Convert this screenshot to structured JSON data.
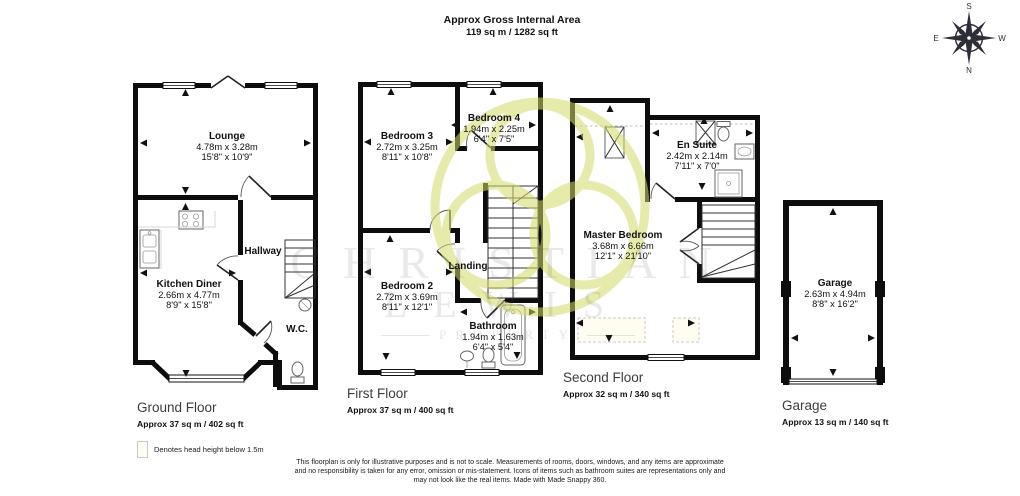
{
  "title": {
    "line1": "Approx Gross Internal Area",
    "line2": "119 sq m / 1282 sq ft"
  },
  "compass": {
    "north": "N",
    "south": "S",
    "east": "E",
    "west": "W"
  },
  "watermark": {
    "line1": "CHRISTIAN",
    "line2": "LEWIS",
    "line3": "PROPERTY"
  },
  "floors": [
    {
      "name": "Ground Floor",
      "area": "Approx 37 sq m / 402 sq ft",
      "rooms": [
        {
          "name": "Lounge",
          "metric": "4.78m x 3.28m",
          "imperial": "15'8\" x 10'9\""
        },
        {
          "name": "Kitchen Diner",
          "metric": "2.66m x 4.77m",
          "imperial": "8'9\" x 15'8\""
        },
        {
          "name": "Hallway"
        },
        {
          "name": "W.C."
        }
      ]
    },
    {
      "name": "First Floor",
      "area": "Approx 37 sq m / 400 sq ft",
      "rooms": [
        {
          "name": "Bedroom 3",
          "metric": "2.72m x 3.25m",
          "imperial": "8'11\" x 10'8\""
        },
        {
          "name": "Bedroom 4",
          "metric": "1.94m x 2.25m",
          "imperial": "6'4\" x 7'5\""
        },
        {
          "name": "Bedroom 2",
          "metric": "2.72m x 3.69m",
          "imperial": "8'11\" x 12'1\""
        },
        {
          "name": "Landing"
        },
        {
          "name": "Bathroom",
          "metric": "1.94m x 1.63m",
          "imperial": "6'4\" x 5'4\""
        }
      ]
    },
    {
      "name": "Second Floor",
      "area": "Approx 32 sq m / 340 sq ft",
      "rooms": [
        {
          "name": "Master Bedroom",
          "metric": "3.68m x 6.66m",
          "imperial": "12'1\" x 21'10\""
        },
        {
          "name": "En Suite",
          "metric": "2.42m x 2.14m",
          "imperial": "7'11\" x 7'0\""
        }
      ]
    },
    {
      "name": "Garage",
      "area": "Approx 13 sq m / 140 sq ft",
      "rooms": [
        {
          "name": "Garage",
          "metric": "2.63m x 4.94m",
          "imperial": "8'8\" x 16'2\""
        }
      ]
    }
  ],
  "legend": {
    "label": "Denotes head height below 1.5m"
  },
  "disclaimer": {
    "line1": "This floorplan is only for illustrative purposes and is not to scale. Measurements of rooms, doors, windows, and any items are approximate",
    "line2": "and no responsibility is taken for any error, omission or mis-statement. Icons of items such as bathroom suites are representations only and",
    "line3": "may not look like the real items. Made with Made Snappy 360."
  },
  "colors": {
    "wall": "#0d0d0d",
    "watermark_green": "#d3db67",
    "floor_label": "#3d3d3d",
    "head_height_fill": "#fffdf0"
  }
}
